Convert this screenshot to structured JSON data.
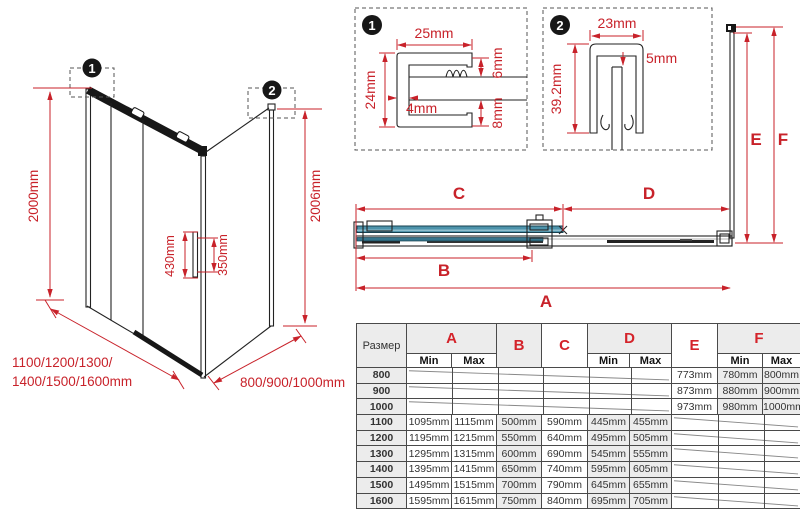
{
  "iso": {
    "callout1": "1",
    "callout2": "2",
    "height_left": "2000mm",
    "height_right": "2006mm",
    "handle_length": "430mm",
    "handle_spacing": "350mm",
    "width_sizes_line1": "1100/1200/1300/",
    "width_sizes_line2": "1400/1500/1600mm",
    "depth_sizes": "800/900/1000mm"
  },
  "detail1": {
    "callout": "1",
    "dim_top": "25mm",
    "dim_left": "24mm",
    "dim_web": "4mm",
    "dim_gap_top": "6mm",
    "dim_gap_bottom": "8mm"
  },
  "detail2": {
    "callout": "2",
    "dim_top": "23mm",
    "dim_gap": "5mm",
    "dim_height": "39.2mm"
  },
  "plan": {
    "dim_a": "A",
    "dim_b": "B",
    "dim_c": "C",
    "dim_d": "D",
    "dim_e": "E",
    "dim_f": "F"
  },
  "table": {
    "size_header": "Размер",
    "col_a": "A",
    "col_b": "B",
    "col_c": "C",
    "col_d": "D",
    "col_e": "E",
    "col_f": "F",
    "min": "Min",
    "max": "Max",
    "rows": [
      {
        "size": "800",
        "e": "773mm",
        "f_min": "780mm",
        "f_max": "800mm"
      },
      {
        "size": "900",
        "e": "873mm",
        "f_min": "880mm",
        "f_max": "900mm"
      },
      {
        "size": "1000",
        "e": "973mm",
        "f_min": "980mm",
        "f_max": "1000mm"
      },
      {
        "size": "1100",
        "a_min": "1095mm",
        "a_max": "1115mm",
        "b": "500mm",
        "c": "590mm",
        "d_min": "445mm",
        "d_max": "455mm"
      },
      {
        "size": "1200",
        "a_min": "1195mm",
        "a_max": "1215mm",
        "b": "550mm",
        "c": "640mm",
        "d_min": "495mm",
        "d_max": "505mm"
      },
      {
        "size": "1300",
        "a_min": "1295mm",
        "a_max": "1315mm",
        "b": "600mm",
        "c": "690mm",
        "d_min": "545mm",
        "d_max": "555mm"
      },
      {
        "size": "1400",
        "a_min": "1395mm",
        "a_max": "1415mm",
        "b": "650mm",
        "c": "740mm",
        "d_min": "595mm",
        "d_max": "605mm"
      },
      {
        "size": "1500",
        "a_min": "1495mm",
        "a_max": "1515mm",
        "b": "700mm",
        "c": "790mm",
        "d_min": "645mm",
        "d_max": "655mm"
      },
      {
        "size": "1600",
        "a_min": "1595mm",
        "a_max": "1615mm",
        "b": "750mm",
        "c": "840mm",
        "d_min": "695mm",
        "d_max": "705mm"
      }
    ]
  },
  "colors": {
    "dimension_red": "#c8222a",
    "glass_blue": "#4d93ab",
    "table_shade_gray": "#ececec"
  }
}
